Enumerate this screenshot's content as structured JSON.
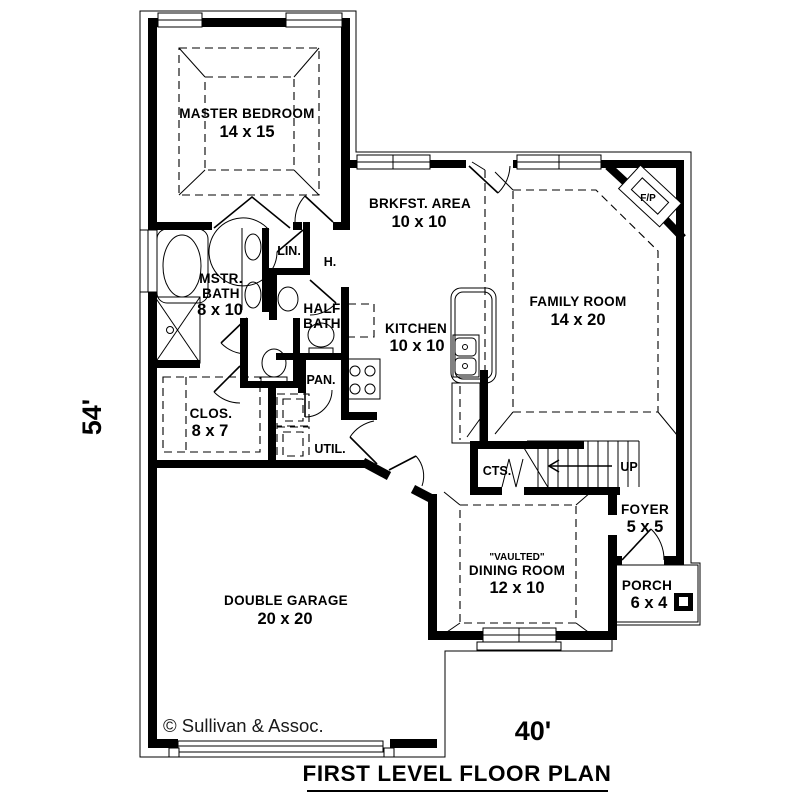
{
  "plan": {
    "title": "FIRST LEVEL FLOOR PLAN",
    "copyright": "© Sullivan & Assoc.",
    "width_dim": "40'",
    "height_dim": "54'"
  },
  "rooms": {
    "master_bedroom": {
      "name": "MASTER BEDROOM",
      "dims": "14 x 15"
    },
    "breakfast": {
      "name": "BRKFST. AREA",
      "dims": "10 x 10"
    },
    "family_room": {
      "name": "FAMILY ROOM",
      "dims": "14 x 20"
    },
    "kitchen": {
      "name": "KITCHEN",
      "dims": "10 x 10"
    },
    "master_bath": {
      "line1": "MSTR.",
      "line2": "BATH",
      "dims": "8 x 10"
    },
    "half_bath": {
      "line1": "HALF",
      "line2": "BATH"
    },
    "linen": {
      "name": "LIN."
    },
    "hall": {
      "name": "H."
    },
    "pantry": {
      "name": "PAN."
    },
    "utility": {
      "name": "UTIL."
    },
    "closet": {
      "name": "CLOS.",
      "dims": "8 x 7"
    },
    "coats": {
      "name": "CTS."
    },
    "stairs": {
      "up_label": "UP"
    },
    "foyer": {
      "name": "FOYER",
      "dims": "5 x 5"
    },
    "dining": {
      "tag": "\"VAULTED\"",
      "name": "DINING ROOM",
      "dims": "12 x 10"
    },
    "porch": {
      "name": "PORCH",
      "dims": "6 x 4"
    },
    "garage": {
      "name": "DOUBLE GARAGE",
      "dims": "20 x 20"
    },
    "fireplace": {
      "name": "F/P"
    }
  },
  "colors": {
    "wall": "#000000",
    "background": "#ffffff",
    "copyright_text": "#1a1a1a"
  }
}
